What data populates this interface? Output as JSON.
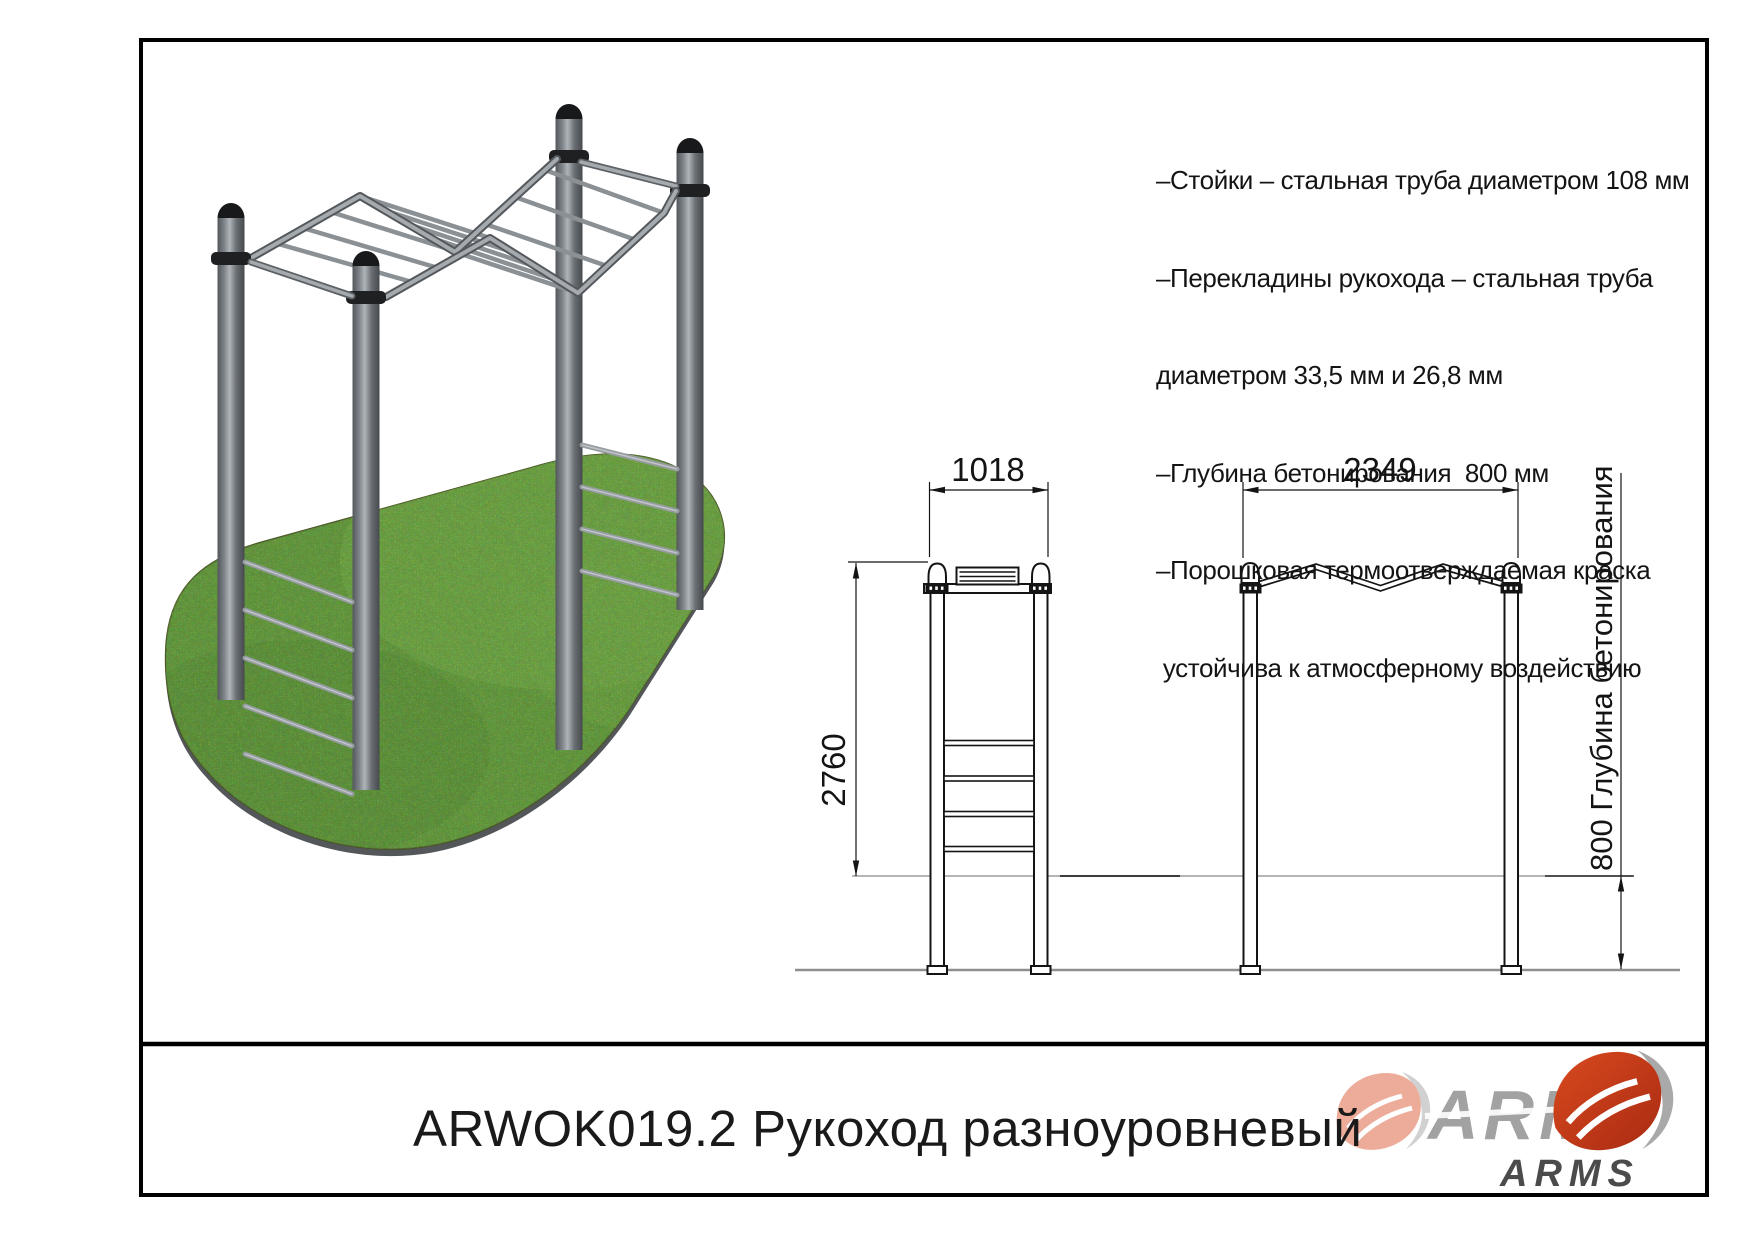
{
  "specs": {
    "lines": [
      "–Стойки – стальная труба диаметром 108 мм",
      "–Перекладины рукохода – стальная труба",
      "диаметром 33,5 мм и 26,8 мм",
      "–Глубина бетонирования  800 мм",
      "–Порошковая термоотверждаемая краска",
      " устойчива к атмосферному воздействию"
    ]
  },
  "dimensions": {
    "front_width": "1018",
    "side_width": "2349",
    "height": "2760",
    "depth_note": "800 Глубина бетонирования"
  },
  "title_block": {
    "code_and_name": "ARWOK019.2 Рукоход разноуровневый",
    "brand_large": "ARMS",
    "brand_small": "ARMS"
  },
  "colors": {
    "accent_red": "#c8371b",
    "logo_gray": "#a2a2a2",
    "grass_green": "#5a8f2d",
    "post_gray": "#6e7478",
    "ground_line": "#b5b5b5"
  }
}
